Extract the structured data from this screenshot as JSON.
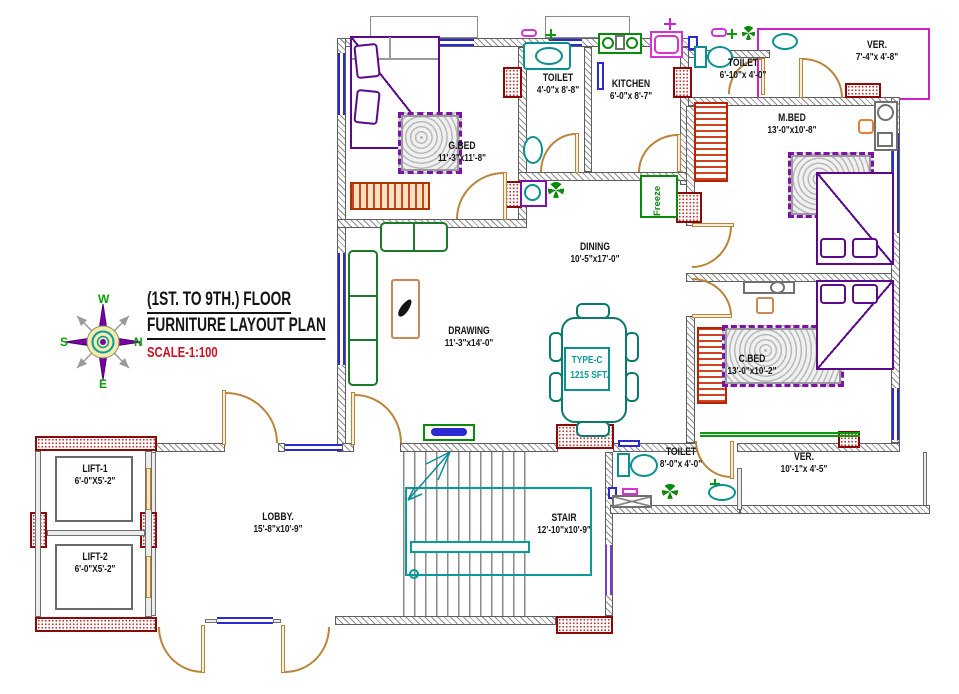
{
  "title": {
    "line1": "(1ST. TO 9TH.) FLOOR",
    "line2": "FURNITURE LAYOUT PLAN",
    "scale": "SCALE-1:100"
  },
  "unit": {
    "type": "TYPE-C",
    "area": "1215 SFT."
  },
  "compass": {
    "n": "N",
    "s": "S",
    "e": "E",
    "w": "W"
  },
  "appliances": {
    "freeze": "Freeze"
  },
  "rooms": {
    "gbed": {
      "name": "G.BED",
      "dims": "11'-3\"x11'-8\""
    },
    "toilet_top": {
      "name": "TOILET",
      "dims": "4'-0\"x 8'-8\""
    },
    "kitchen": {
      "name": "KITCHEN",
      "dims": "6'-0\"x 8'-7\""
    },
    "toilet_mid": {
      "name": "TOILET",
      "dims": "6'-10\"x 4'-0\""
    },
    "ver_top": {
      "name": "VER.",
      "dims": "7'-4\"x 4'-8\""
    },
    "mbed": {
      "name": "M.BED",
      "dims": "13'-0\"x10'-8\""
    },
    "dining": {
      "name": "DINING",
      "dims": "10'-5\"x17'-0\""
    },
    "drawing": {
      "name": "DRAWING",
      "dims": "11'-3\"x14'-0\""
    },
    "cbed": {
      "name": "C.BED",
      "dims": "13'-0\"x10'-2\""
    },
    "toilet_bottom": {
      "name": "TOILET",
      "dims": "8'-0\"x 4'-0\""
    },
    "ver_bottom": {
      "name": "VER.",
      "dims": "10'-1\"x 4'-5\""
    },
    "lobby": {
      "name": "LOBBY.",
      "dims": "15'-8\"x10'-9\""
    },
    "stair": {
      "name": "STAIR",
      "dims": "12'-10\"x10'-9\""
    },
    "lift1": {
      "name": "LIFT-1",
      "dims": "6'-0\"X5'-2\""
    },
    "lift2": {
      "name": "LIFT-2",
      "dims": "6'-0\"X5'-2\""
    }
  },
  "colors": {
    "wall_hatch": "#8f8f8f",
    "column_red": "#8a0a0a",
    "window_blue": "#2a2ad0",
    "door_tan": "#b8863b",
    "furniture_green": "#1a7a2a",
    "furniture_purple": "#5a0a8a",
    "fixture_teal": "#0a9090",
    "accent_magenta": "#cc22cc",
    "scale_red": "#cc1122",
    "compass_green": "#0a9a0a",
    "text_black": "#141414"
  }
}
